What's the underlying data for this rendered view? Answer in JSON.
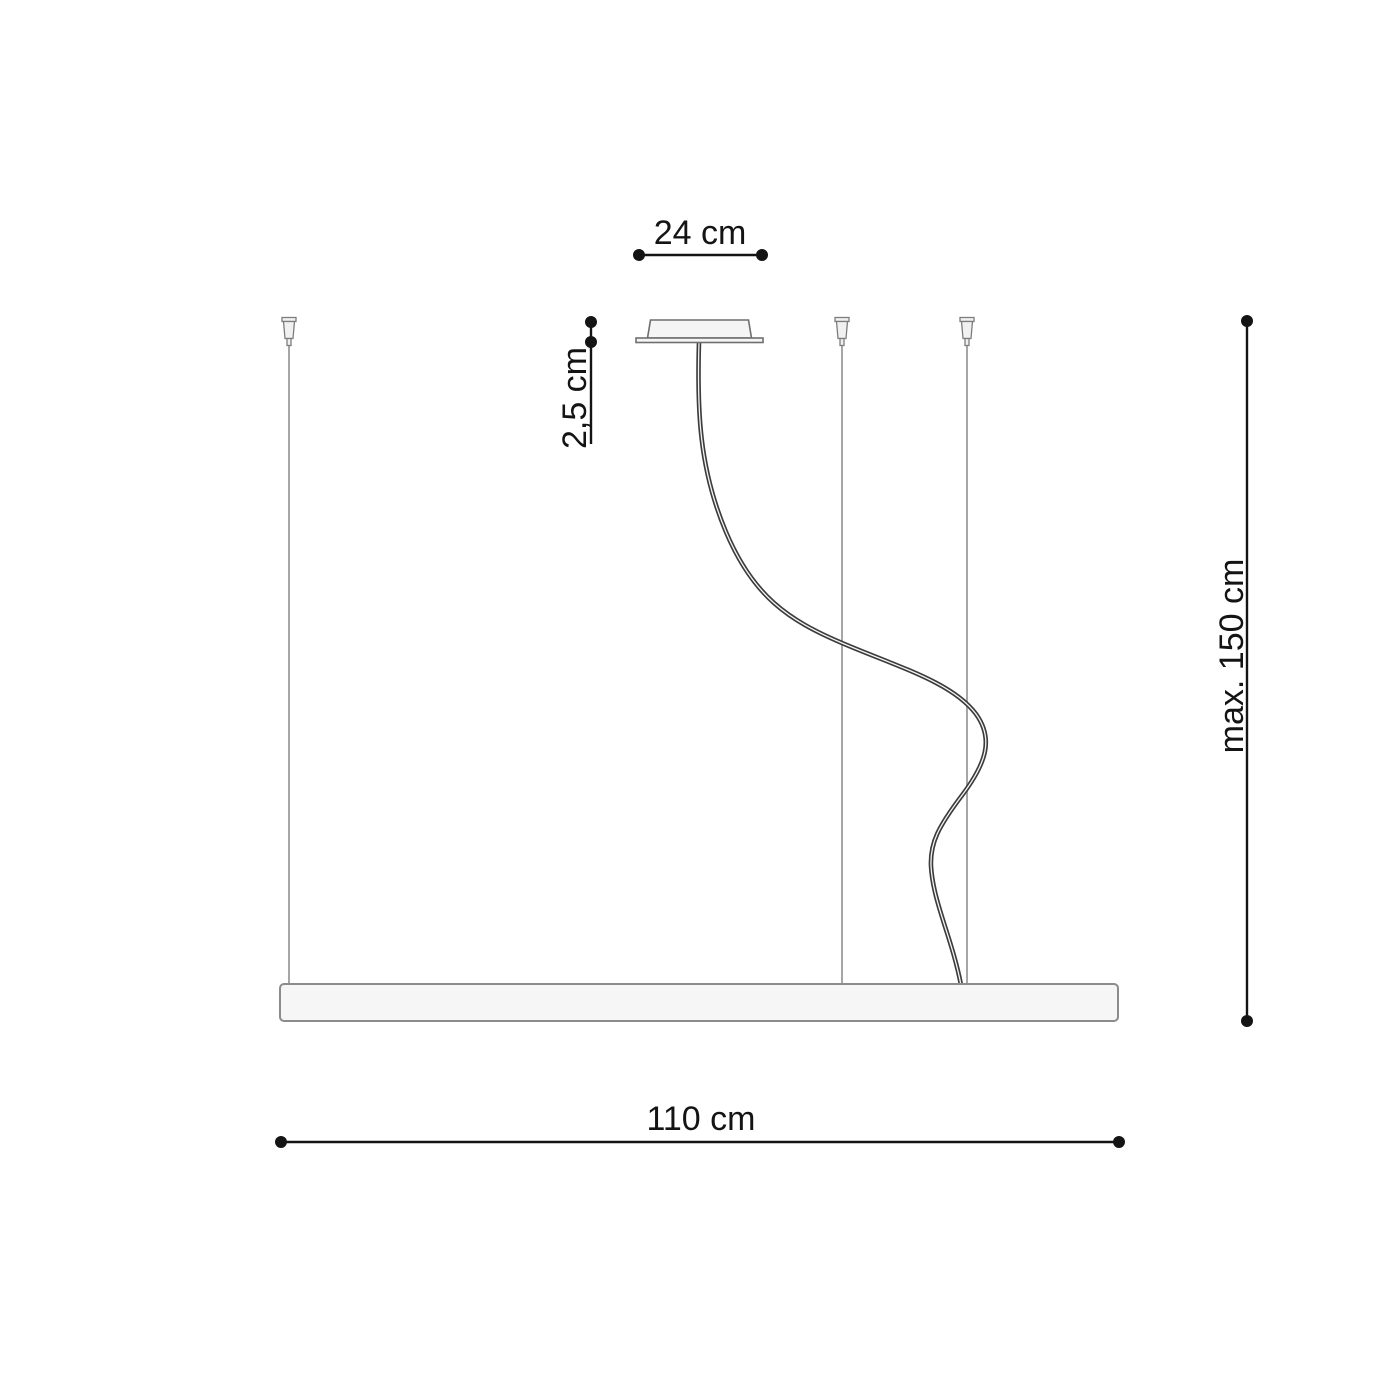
{
  "diagram": {
    "labels": {
      "canopy_width": "24 cm",
      "canopy_height": "2,5 cm",
      "max_suspension": "max. 150 cm",
      "fixture_width": "110 cm"
    },
    "values": {
      "canopy_width_cm": 24,
      "canopy_height_cm": 2.5,
      "max_suspension_cm": 150,
      "fixture_width_cm": 110
    },
    "colors": {
      "background": "#ffffff",
      "dimension_line": "#141414",
      "wire": "#a6a6a6",
      "connector_fill": "#f1f1f1",
      "connector_stroke": "#7d7d7d",
      "cable": "#3c3c3c",
      "cable_core": "#f5f5f5",
      "fixture_fill": "#f5f5f5",
      "fixture_stroke": "#6f6f6f",
      "bar_fill": "#f6f6f6",
      "bar_stroke": "#8c8c8c"
    }
  }
}
